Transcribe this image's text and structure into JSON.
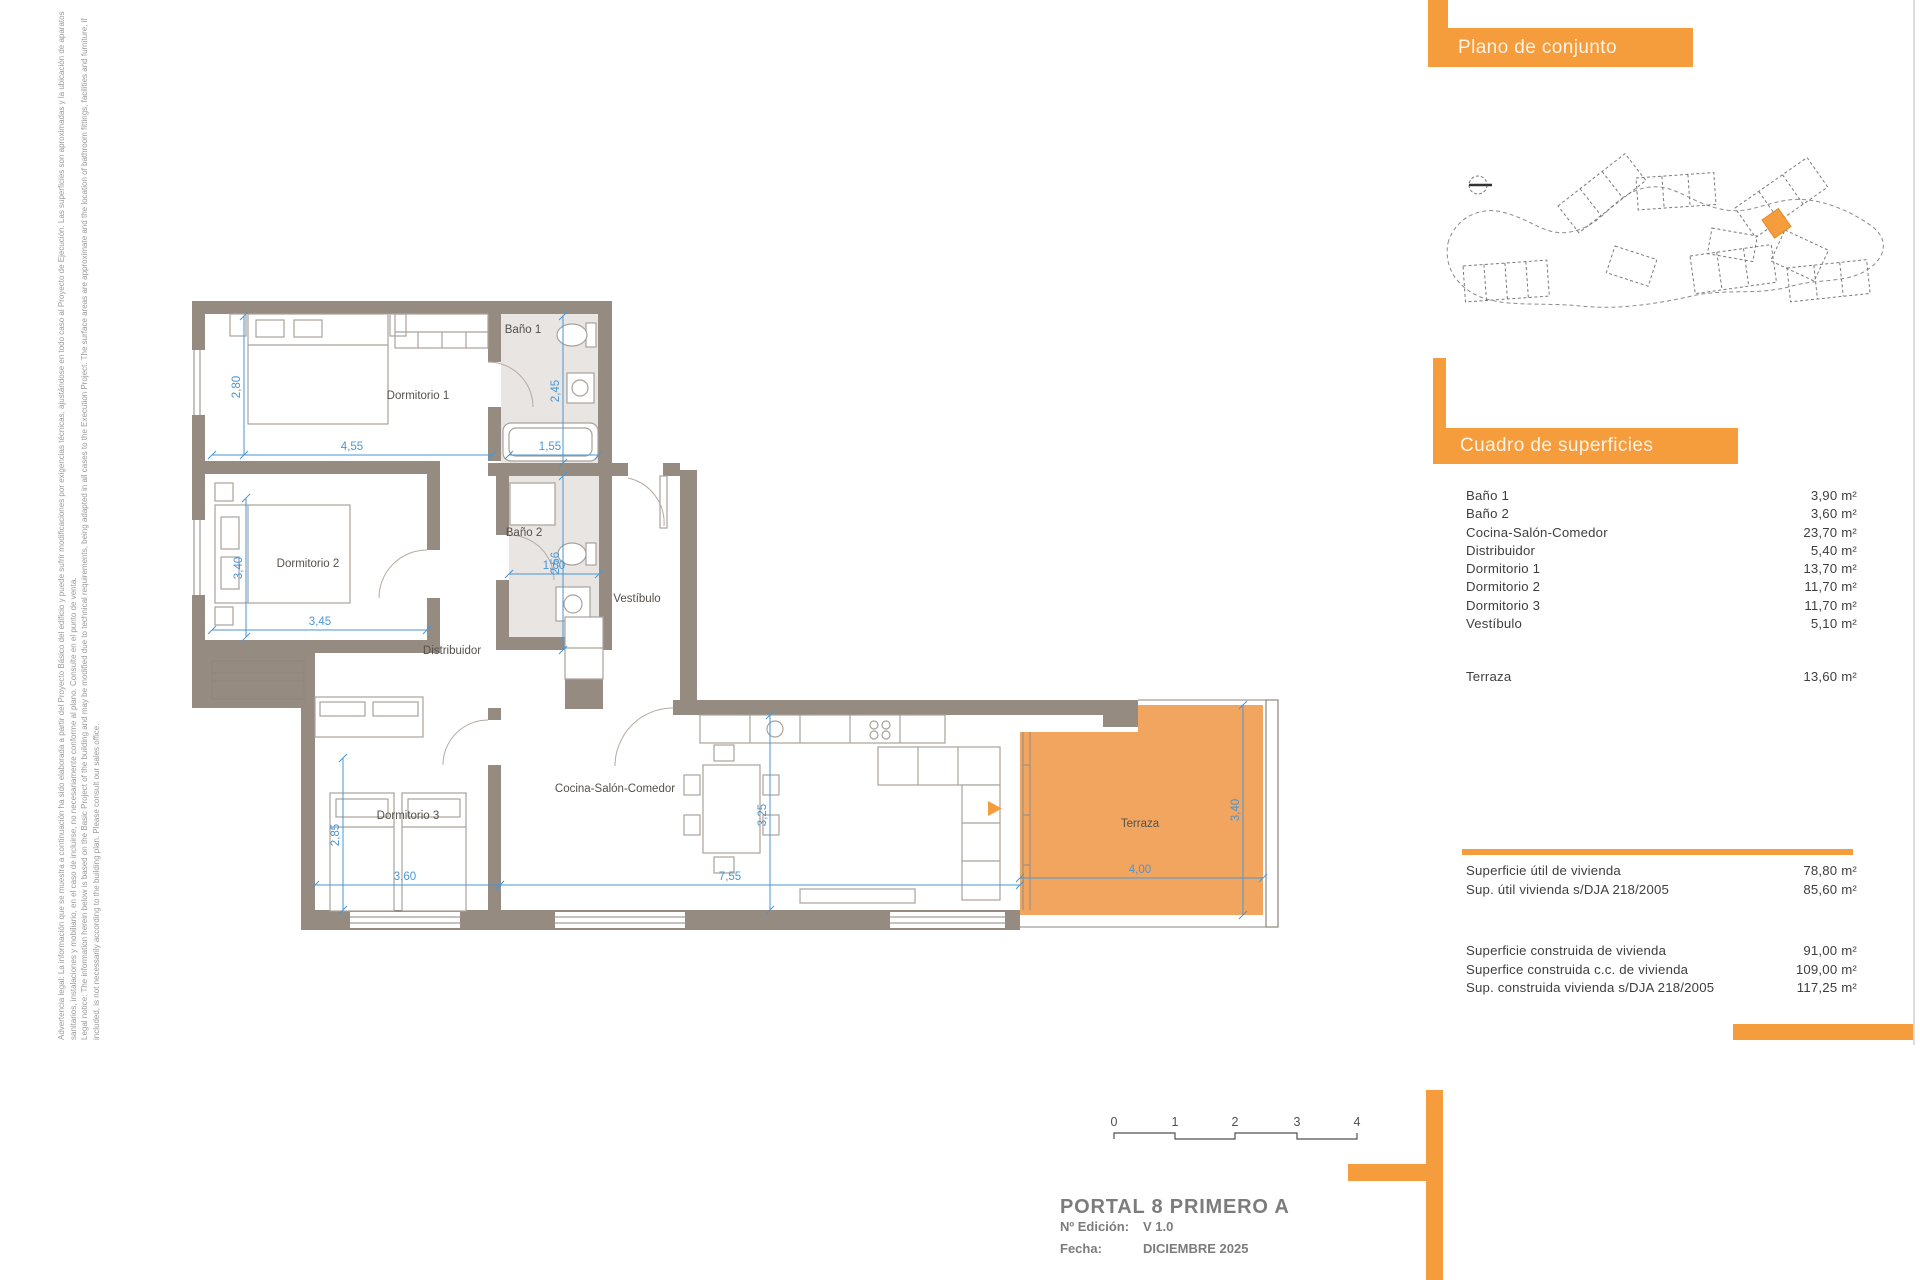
{
  "legal": {
    "l1": "Advertencia legal: La información que se muestra a continuación ha sido elaborada a partir del Proyecto Básico del edificio y puede sufrir modificaciones por exigencias técnicas, ajustándose en todo caso al Proyecto de Ejecución. Las superficies son aproximadas y la ubicación de aparatos",
    "l2": "sanitarios, instalaciones y mobiliario, en el caso de incluirse, no necesariamente conforme al plano. Consulte en el punto de venta.",
    "l3": "Legal notice: The information herein below is based on the Basic Project of the building and may be modified due to technical requirements, being adapted in all cases to the Execution Project. The surface areas are approximate and the location of bathroom fittings, facilities and furniture, if",
    "l4": "included, is not necessarily according to the building plan. Please consult our sales office."
  },
  "site_plan": {
    "title": "Plano de conjunto"
  },
  "surfaces": {
    "title": "Cuadro de superficies",
    "rows": [
      {
        "label": "Baño 1",
        "value": "3,90 m²"
      },
      {
        "label": "Baño 2",
        "value": "3,60 m²"
      },
      {
        "label": "Cocina-Salón-Comedor",
        "value": "23,70 m²"
      },
      {
        "label": "Distribuidor",
        "value": "5,40 m²"
      },
      {
        "label": "Dormitorio 1",
        "value": "13,70 m²"
      },
      {
        "label": "Dormitorio 2",
        "value": "11,70 m²"
      },
      {
        "label": "Dormitorio 3",
        "value": "11,70 m²"
      },
      {
        "label": "Vestíbulo",
        "value": "5,10 m²"
      }
    ],
    "terraza_row": {
      "label": "Terraza",
      "value": "13,60 m²"
    },
    "summary_util": [
      {
        "label": "Superficie útil de vivienda",
        "value": "78,80 m²"
      },
      {
        "label": "Sup. útil vivienda s/DJA 218/2005",
        "value": "85,60 m²"
      }
    ],
    "summary_construida": [
      {
        "label": "Superficie construida de vivienda",
        "value": "91,00 m²"
      },
      {
        "label": "Superfice construida c.c. de vivienda",
        "value": "109,00 m²"
      },
      {
        "label": "Sup. construida vivienda s/DJA 218/2005",
        "value": "117,25 m²"
      }
    ]
  },
  "plan": {
    "rooms": {
      "dorm1": "Dormitorio 1",
      "dorm2": "Dormitorio 2",
      "dorm3": "Dormitorio 3",
      "bano1": "Baño 1",
      "bano2": "Baño 2",
      "vestibulo": "Vestíbulo",
      "distribuidor": "Distribuidor",
      "cocina": "Cocina-Salón-Comedor",
      "terraza": "Terraza"
    },
    "dims": {
      "dorm1_h": "2,80",
      "dorm1_w": "4,55",
      "bano1_h": "2,45",
      "bano1_w": "1,55",
      "dorm2_h": "3,40",
      "dorm2_w": "3,45",
      "bano2_h": "2,56",
      "bano2_w": "1,60",
      "dorm3_h": "2,85",
      "dorm3_w": "3,60",
      "salon_w": "7,55",
      "salon_h": "3,25",
      "terraza_w": "4,00",
      "terraza_h": "3,40"
    }
  },
  "scalebar": {
    "ticks": [
      "0",
      "1",
      "2",
      "3",
      "4"
    ]
  },
  "titleblock": {
    "title": "PORTAL 8 PRIMERO A",
    "edition_label": "Nº Edición:",
    "edition_value": "V 1.0",
    "date_label": "Fecha:",
    "date_value": "DICIEMBRE 2025"
  },
  "colors": {
    "brand_orange": "#F59C3C",
    "terrace_orange": "#F2A55F",
    "wall_grey": "#968B81",
    "dimension_blue": "#4A96D4",
    "bath_fill": "#E8E5E2"
  }
}
